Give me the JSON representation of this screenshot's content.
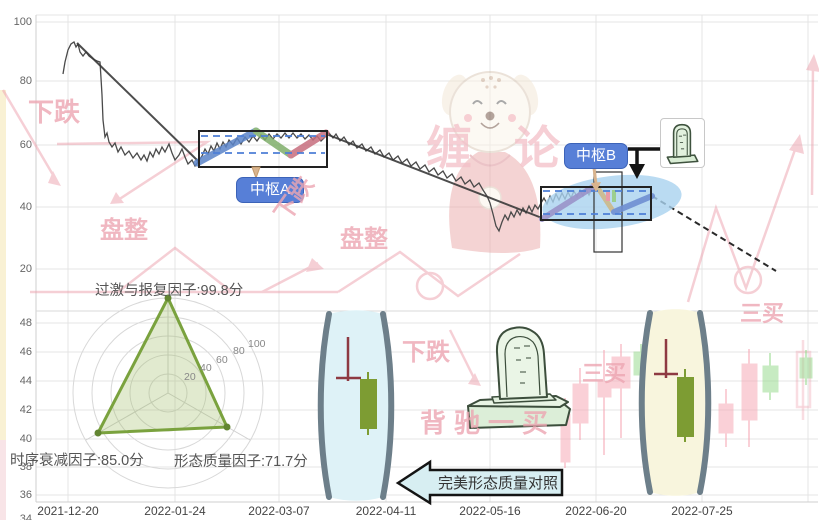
{
  "main_chart": {
    "y_ticks": [
      "100",
      "80",
      "60",
      "40",
      "20"
    ],
    "x_ticks": [
      "2021-12-20",
      "2022-01-24",
      "2022-03-07",
      "2022-04-11",
      "2022-05-16",
      "2022-06-20",
      "2022-07-25"
    ],
    "pivot_a": {
      "label": "中枢A"
    },
    "pivot_b": {
      "label": "中枢B"
    }
  },
  "sub_chart": {
    "y_ticks": [
      "48",
      "46",
      "44",
      "42",
      "40",
      "38",
      "36",
      "34"
    ]
  },
  "radar": {
    "top_label": "过激与报复因子:99.8分",
    "left_label": "时序衰减因子:85.0分",
    "right_label": "形态质量因子:71.7分",
    "scale_ticks": [
      "20",
      "40",
      "60",
      "80",
      "100"
    ]
  },
  "callout": {
    "text": "完美形态质量对照"
  },
  "watermarks": {
    "brand_left": "缠",
    "brand_right": "论",
    "decline_1": "下跌",
    "consolidation_1": "盘整",
    "decline_2": "下跌",
    "consolidation_2": "盘整",
    "third_buy_1": "三买",
    "decline_3": "下跌",
    "divergence_first_buy": "背驰一买",
    "third_buy_2": "三买"
  },
  "colors": {
    "chip_blue": "#577fd7",
    "segment_blue": "#5b84c8",
    "segment_green": "#7fae6a",
    "segment_pink": "#c76e7e",
    "segment_purple": "#9a93c9",
    "segment_tan": "#cdb98a",
    "lens_left_fill": "#def2f7",
    "lens_right_fill": "#f8f5dd",
    "candle_green": "#7d9c33",
    "doji_red": "#8e3a42",
    "faded_pink": "#f6aab8",
    "faded_green": "#9adb92",
    "radar_green": "#7aa23e",
    "watermark_pink": "#eda6b2",
    "ellipse_blue": "#a9d2ef"
  },
  "chart_data": {
    "type": "line",
    "title": "",
    "panels": [
      {
        "name": "main_price_panel",
        "ylim": [
          10,
          105
        ],
        "y_ticks": [
          20,
          40,
          60,
          80,
          100
        ],
        "x_ticks": [
          "2021-12-20",
          "2022-01-24",
          "2022-03-07",
          "2022-04-11",
          "2022-05-16",
          "2022-06-20",
          "2022-07-25"
        ],
        "grid": true,
        "series": [
          {
            "name": "price_approx",
            "points": [
              [
                "2021-12-20",
                75
              ],
              [
                "2021-12-22",
                93
              ],
              [
                "2021-12-29",
                87
              ],
              [
                "2021-12-31",
                60
              ],
              [
                "2022-01-10",
                55
              ],
              [
                "2022-01-24",
                56
              ],
              [
                "2022-02-07",
                64
              ],
              [
                "2022-02-14",
                57
              ],
              [
                "2022-02-21",
                64
              ],
              [
                "2022-03-07",
                62
              ],
              [
                "2022-03-21",
                58
              ],
              [
                "2022-04-11",
                48
              ],
              [
                "2022-04-25",
                33
              ],
              [
                "2022-05-09",
                41
              ],
              [
                "2022-05-16",
                43
              ],
              [
                "2022-05-30",
                46
              ],
              [
                "2022-06-06",
                38
              ],
              [
                "2022-06-13",
                43
              ],
              [
                "2022-06-20",
                42
              ],
              [
                "2022-07-25",
                22
              ]
            ]
          }
        ],
        "pivots": [
          {
            "label": "中枢A",
            "date_range": [
              "2022-01-24",
              "2022-03-07"
            ],
            "price_range": [
              53,
              64.5
            ]
          },
          {
            "label": "中枢B",
            "date_range": [
              "2022-05-16",
              "2022-06-20"
            ],
            "price_range": [
              36.2,
              46.2
            ]
          }
        ]
      },
      {
        "name": "sub_candle_panel",
        "ylim": [
          33.5,
          49
        ],
        "y_ticks": [
          34,
          36,
          38,
          40,
          42,
          44,
          46,
          48
        ],
        "grid": true,
        "highlight_candles": [
          {
            "position": "left_lens",
            "doji_high": 47.0,
            "doji_cross_level": 44.1,
            "candle": {
              "open": 44.1,
              "close": 40.7,
              "high": 44.7,
              "low": 40.3,
              "color": "green"
            }
          },
          {
            "position": "right_lens",
            "doji_high": 46.9,
            "doji_cross_level": 44.4,
            "candle": {
              "open": 44.3,
              "close": 40.1,
              "high": 44.8,
              "low": 39.8,
              "color": "green"
            }
          }
        ],
        "background_candles_approx": [
          {
            "open": 41.7,
            "close": 38.4,
            "high": 42.8,
            "low": 38.0,
            "color": "red"
          },
          {
            "open": 43.8,
            "close": 41.1,
            "high": 44.9,
            "low": 39.9,
            "color": "red"
          },
          {
            "open": 43.9,
            "close": 42.9,
            "high": 46.1,
            "low": 38.9,
            "color": "red"
          },
          {
            "open": 45.7,
            "close": 43.5,
            "high": 46.6,
            "low": 40.1,
            "color": "red"
          },
          {
            "open": 44.4,
            "close": 46.0,
            "high": 46.6,
            "low": 43.7,
            "color": "green"
          },
          {
            "open": 42.4,
            "close": 40.4,
            "high": 43.2,
            "low": 39.4,
            "color": "red"
          },
          {
            "open": 45.2,
            "close": 41.3,
            "high": 46.2,
            "low": 39.4,
            "color": "red"
          },
          {
            "open": 43.2,
            "close": 45.0,
            "high": 45.9,
            "low": 42.7,
            "color": "green"
          }
        ]
      }
    ],
    "radar": {
      "type": "radar",
      "axes": [
        "过激与报复因子",
        "时序衰减因子",
        "形态质量因子"
      ],
      "values": [
        99.8,
        85.0,
        71.7
      ],
      "max": 100,
      "scale_ticks": [
        20,
        40,
        60,
        80,
        100
      ]
    }
  }
}
